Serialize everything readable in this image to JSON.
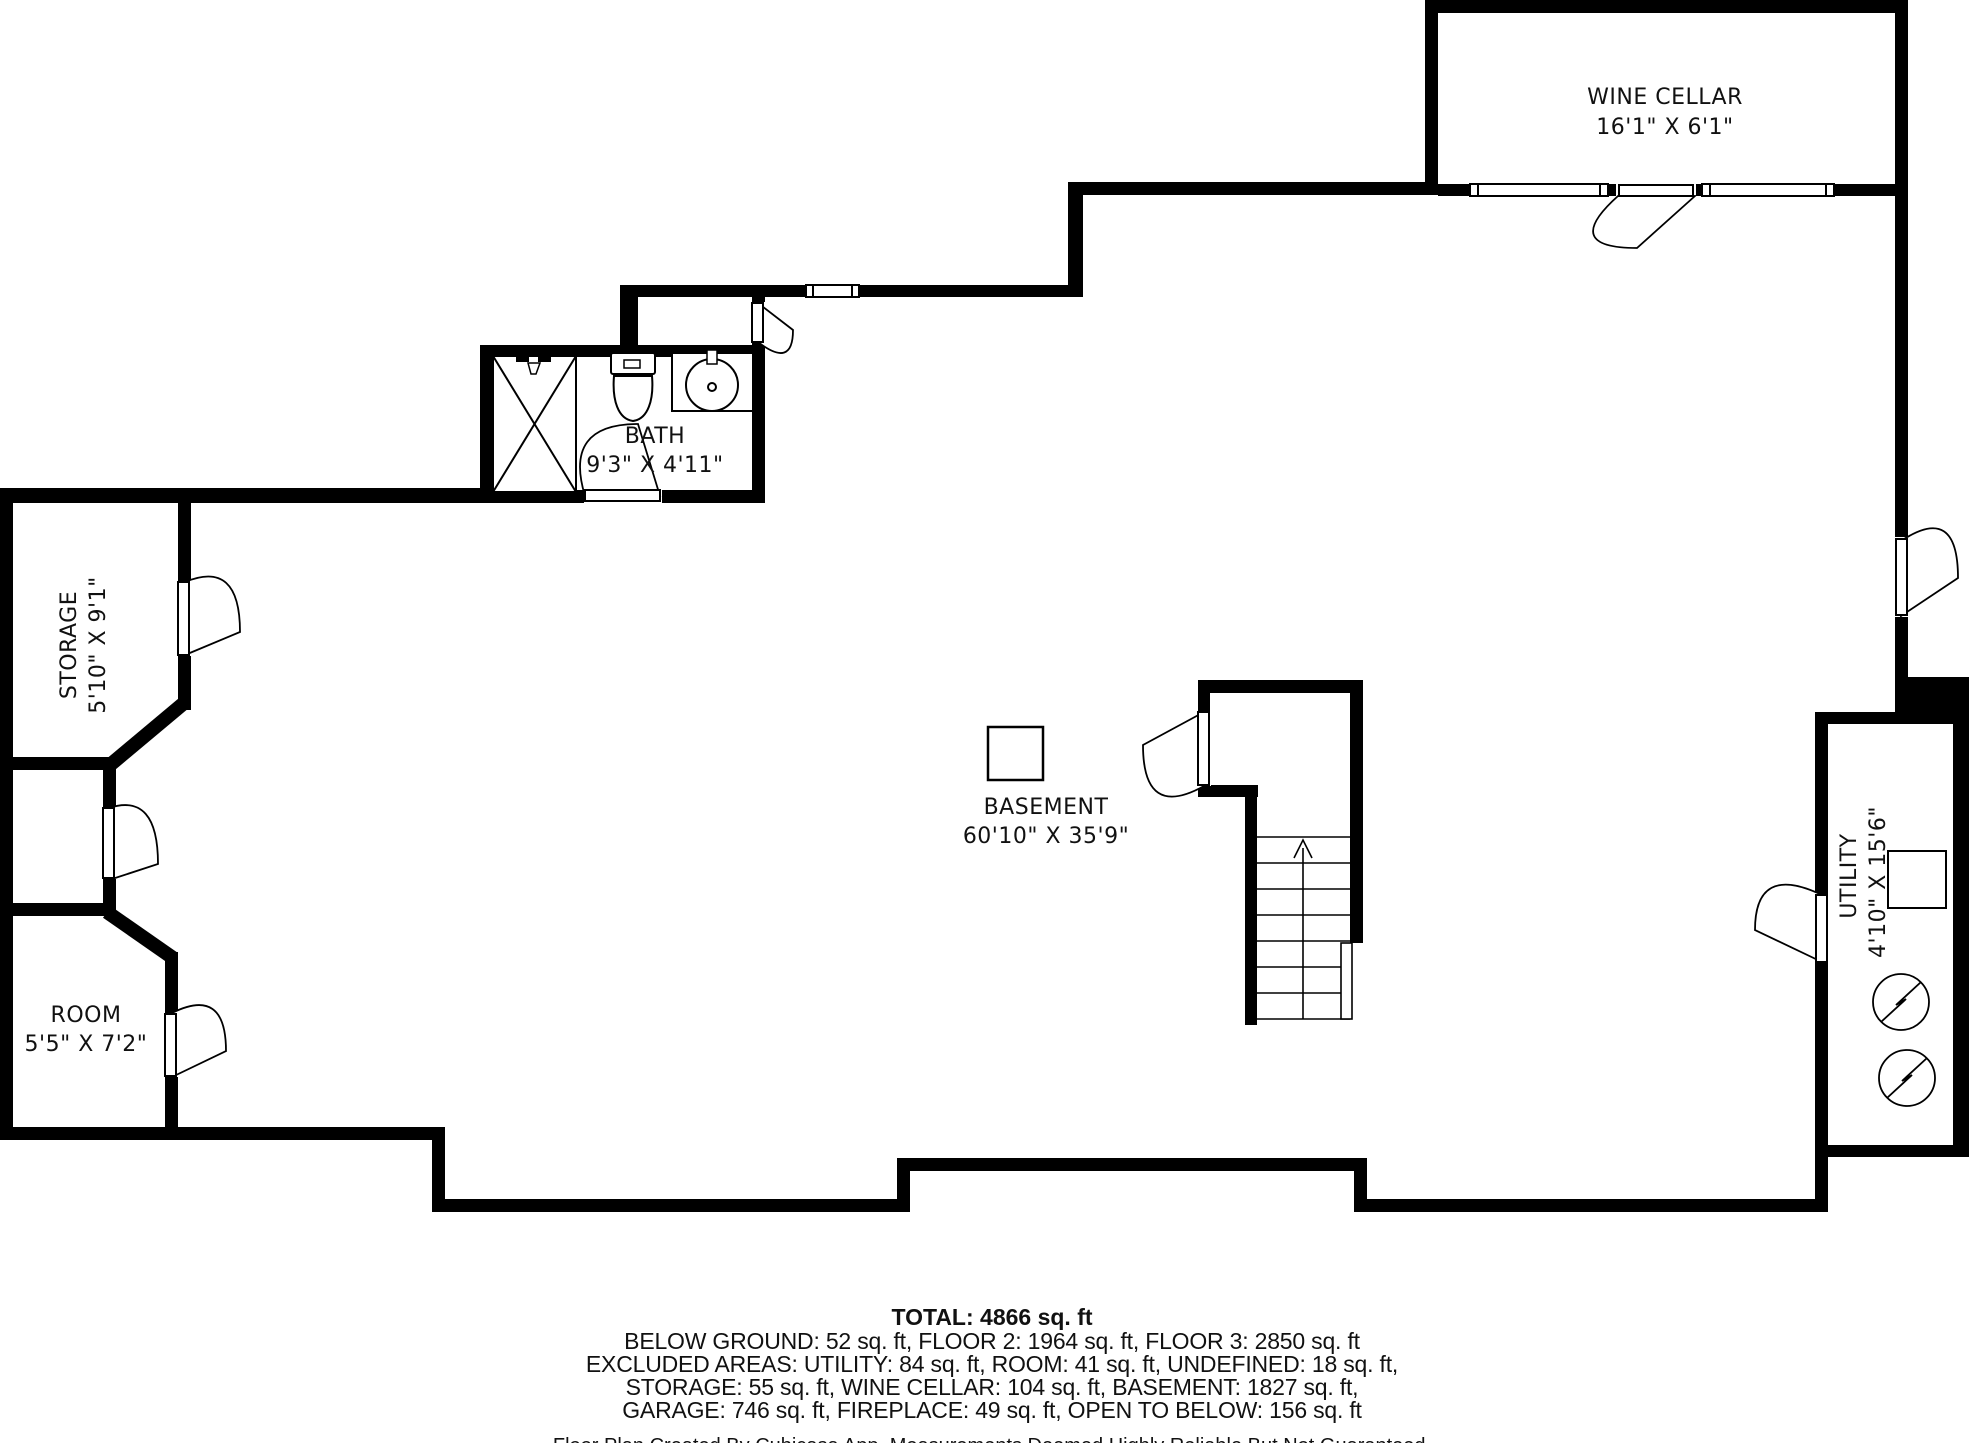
{
  "title": "Floor Plan",
  "rooms": [
    {
      "id": "wine-cellar",
      "name": "WINE CELLAR",
      "dims": "16'1\" X 6'1\""
    },
    {
      "id": "bath",
      "name": "BATH",
      "dims": "9'3\" X 4'11\""
    },
    {
      "id": "storage",
      "name": "STORAGE",
      "dims": "5'10\" X 9'1\""
    },
    {
      "id": "room",
      "name": "ROOM",
      "dims": "5'5\" X 7'2\""
    },
    {
      "id": "basement",
      "name": "BASEMENT",
      "dims": "60'10\" X 35'9\""
    },
    {
      "id": "utility",
      "name": "UTILITY",
      "dims": "4'10\" X 15'6\""
    }
  ],
  "summary": {
    "total": "TOTAL: 4866 sq. ft",
    "line1": "BELOW GROUND: 52 sq. ft, FLOOR 2: 1964 sq. ft, FLOOR 3: 2850 sq. ft",
    "line2": "EXCLUDED AREAS: UTILITY: 84 sq. ft, ROOM: 41 sq. ft, UNDEFINED: 18 sq. ft,",
    "line3": "STORAGE: 55 sq. ft, WINE CELLAR: 104 sq. ft, BASEMENT: 1827 sq. ft,",
    "line4": "GARAGE: 746 sq. ft, FIREPLACE: 49 sq. ft, OPEN TO BELOW: 156 sq. ft"
  },
  "footer": "Floor Plan Created By Cubicasa App. Measurements Deemed Highly Reliable But Not Guaranteed.",
  "colors": {
    "wall": "#000000",
    "background": "#ffffff",
    "text": "#111111"
  }
}
